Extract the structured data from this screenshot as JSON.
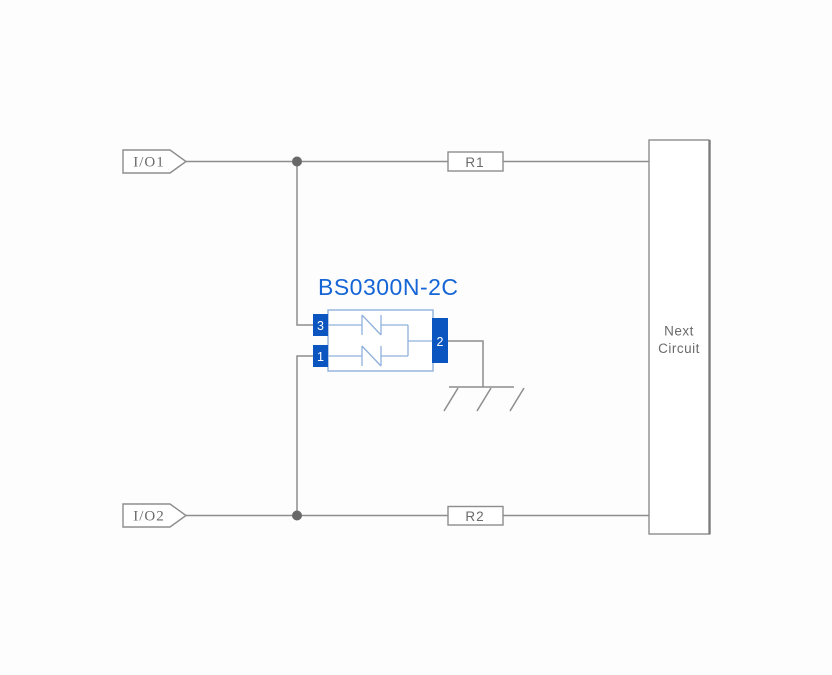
{
  "diagram": {
    "component": {
      "name": "BS0300N-2C",
      "pins": [
        {
          "number": "3"
        },
        {
          "number": "1"
        },
        {
          "number": "2"
        }
      ]
    },
    "ports": [
      {
        "label": "I/O1"
      },
      {
        "label": "I/O2"
      }
    ],
    "resistors": [
      {
        "label": "R1"
      },
      {
        "label": "R2"
      }
    ],
    "next_circuit": {
      "line1": "Next",
      "line2": "Circuit"
    },
    "icons": {
      "ground": "chassis-ground-icon"
    },
    "colors": {
      "accent-blue": "#1565d6",
      "pin-blue": "#0b55c0",
      "body-blue": "#8fb0dc",
      "wire-gray": "#8d8d8d",
      "text-gray": "#6a6a6a",
      "dot-gray": "#686868",
      "background": "#fdfdfd"
    }
  }
}
